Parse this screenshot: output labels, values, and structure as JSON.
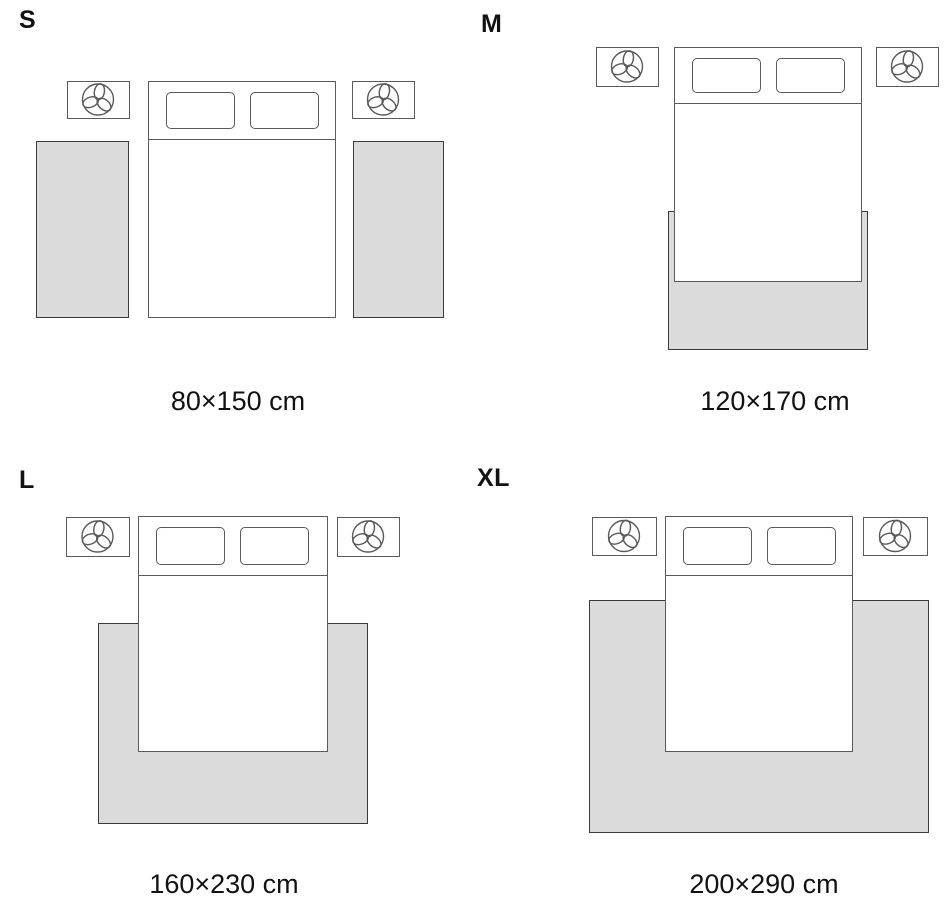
{
  "colors": {
    "background": "#ffffff",
    "text": "#121212",
    "rug_fill": "#dbdbdb",
    "rug_border": "#3a3a3a",
    "furniture_border": "#5a5a5a"
  },
  "icons": {
    "nightstand_icon": "plant-top-view-icon"
  },
  "panels": [
    {
      "label": "S",
      "size_label": "80×150 cm",
      "label_pos": {
        "x": 19,
        "y": 8
      },
      "size_label_center": {
        "x": 238,
        "y": 388
      },
      "bed": {
        "x": 148,
        "y": 81,
        "w": 188,
        "h": 237,
        "head_h": 58
      },
      "nightstands": [
        {
          "x": 67,
          "y": 81,
          "w": 63,
          "h": 38
        },
        {
          "x": 352,
          "y": 81,
          "w": 63,
          "h": 38
        }
      ],
      "rugs": [
        {
          "x": 36,
          "y": 141,
          "w": 93,
          "h": 177
        },
        {
          "x": 353,
          "y": 141,
          "w": 91,
          "h": 177
        }
      ]
    },
    {
      "label": "M",
      "size_label": "120×170 cm",
      "label_pos": {
        "x": 481,
        "y": 12
      },
      "size_label_center": {
        "x": 775,
        "y": 388
      },
      "bed": {
        "x": 674,
        "y": 47,
        "w": 188,
        "h": 235,
        "head_h": 56
      },
      "nightstands": [
        {
          "x": 596,
          "y": 47,
          "w": 63,
          "h": 40
        },
        {
          "x": 876,
          "y": 47,
          "w": 63,
          "h": 40
        }
      ],
      "rugs": [
        {
          "x": 668,
          "y": 211,
          "w": 200,
          "h": 139
        }
      ]
    },
    {
      "label": "L",
      "size_label": "160×230 cm",
      "label_pos": {
        "x": 19,
        "y": 468
      },
      "size_label_center": {
        "x": 224,
        "y": 871
      },
      "bed": {
        "x": 138,
        "y": 516,
        "w": 190,
        "h": 236,
        "head_h": 59
      },
      "nightstands": [
        {
          "x": 66,
          "y": 517,
          "w": 64,
          "h": 40
        },
        {
          "x": 337,
          "y": 517,
          "w": 63,
          "h": 40
        }
      ],
      "rugs": [
        {
          "x": 98,
          "y": 623,
          "w": 270,
          "h": 201
        }
      ]
    },
    {
      "label": "XL",
      "size_label": "200×290 cm",
      "label_pos": {
        "x": 477,
        "y": 466
      },
      "size_label_center": {
        "x": 764,
        "y": 871
      },
      "bed": {
        "x": 665,
        "y": 516,
        "w": 188,
        "h": 236,
        "head_h": 59
      },
      "nightstands": [
        {
          "x": 592,
          "y": 517,
          "w": 65,
          "h": 39
        },
        {
          "x": 863,
          "y": 517,
          "w": 65,
          "h": 39
        }
      ],
      "rugs": [
        {
          "x": 589,
          "y": 600,
          "w": 340,
          "h": 233
        }
      ]
    }
  ]
}
